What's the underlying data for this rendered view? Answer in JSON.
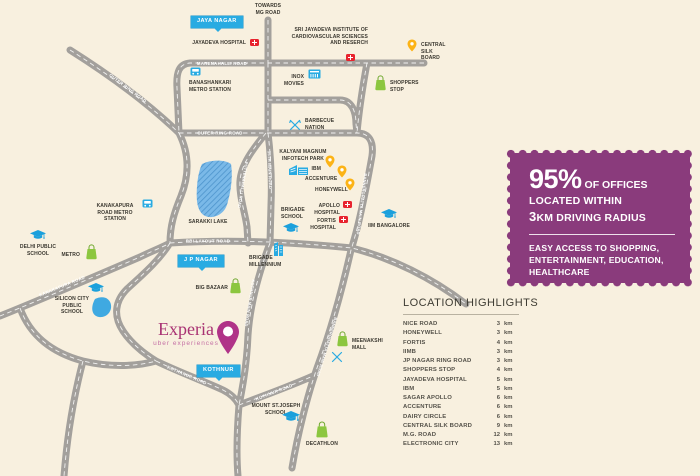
{
  "brand": {
    "name": "Experia",
    "tagline": "uber experiences"
  },
  "infobox": {
    "stat": "95%",
    "stat_suffix": "OF OFFICES",
    "line2": "LOCATED WITHIN",
    "line3_num": "3",
    "line3_rest": "KM DRIVING RADIUS",
    "secondary": "EASY ACCESS TO SHOPPING, ENTERTAINMENT, EDUCATION, HEALTHCARE"
  },
  "highlights": {
    "title": "LOCATION HIGHLIGHTS",
    "items": [
      {
        "name": "NICE ROAD",
        "distance": "3",
        "unit": "km"
      },
      {
        "name": "HONEYWELL",
        "distance": "3",
        "unit": "km"
      },
      {
        "name": "FORTIS",
        "distance": "4",
        "unit": "km"
      },
      {
        "name": "IIMB",
        "distance": "3",
        "unit": "km"
      },
      {
        "name": "JP NAGAR RING ROAD",
        "distance": "3",
        "unit": "km"
      },
      {
        "name": "SHOPPERS STOP",
        "distance": "4",
        "unit": "km"
      },
      {
        "name": "JAYADEVA HOSPITAL",
        "distance": "5",
        "unit": "km"
      },
      {
        "name": "IBM",
        "distance": "5",
        "unit": "km"
      },
      {
        "name": "SAGAR APOLLO",
        "distance": "6",
        "unit": "km"
      },
      {
        "name": "ACCENTURE",
        "distance": "6",
        "unit": "km"
      },
      {
        "name": "DAIRY CIRCLE",
        "distance": "6",
        "unit": "km"
      },
      {
        "name": "CENTRAL SILK BOARD",
        "distance": "9",
        "unit": "km"
      },
      {
        "name": "M.G. ROAD",
        "distance": "12",
        "unit": "km"
      },
      {
        "name": "ELECTRONIC CITY",
        "distance": "13",
        "unit": "km"
      }
    ]
  },
  "map": {
    "direction_label": "TOWARDS MG ROAD",
    "badges": {
      "jaya_nagar": "JAYA NAGAR",
      "jp_nagar": "J P NAGAR",
      "kothnur": "KOTHNUR"
    },
    "roads": {
      "marenahalli": "MARENAHALLI ROAD",
      "outer_ring_1": "OUTER RING ROAD",
      "outer_ring_2": "OUTER RING ROAD",
      "main_15th": "15TH MAIN ROAD",
      "puttenahalli": "PUTTENAHALLI ROAD",
      "rbi_layout": "RBI LAYOUT ROAD",
      "kanakapura": "KANAKAPURA ROAD",
      "bannerghatta_1": "BANNERGHATTA MAIN ROAD",
      "bannerghatta_2": "BANNERGHATTA MAIN ROAD",
      "kothnur_main": "KOTHNUR MAIN ROAD",
      "kothnur_1": "KOTHNUR ROAD",
      "kothanur_2": "KOTHANUR ROAD"
    },
    "landmarks": {
      "jayadeva_hospital": "JAYADEVA HOSPITAL",
      "sri_jayadeva": "SRI JAYADEVA INSTITUTE OF CARDIOVASCULAR SCIENCES AND RESERCH",
      "central_silk_board": "CENTRAL SILK BOARD",
      "banashankari_metro": "BANASHANKARI METRO STATION",
      "inox_movies": "INOX MOVIES",
      "shoppers_stop": "SHOPPERS STOP",
      "barbecue_nation": "BARBECUE NATION",
      "kalyani_magnum": "KALYANI MAGNUM INFOTECH PARK",
      "ibm": "IBM",
      "accenture": "ACCENTURE",
      "honeywell": "HONEYWELL",
      "apollo_hospital": "APOLLO HOSPITAL",
      "fortis_hospital": "FORTIS HOSPITAL",
      "brigade_school": "BRIGADE SCHOOL",
      "sarakki_lake": "SARAKKI LAKE",
      "kanakapura_metro": "KANAKAPURA ROAD METRO STATION",
      "iim_bangalore": "IIM BANGALORE",
      "delhi_public_school": "DELHI PUBLIC SCHOOL",
      "metro_store": "METRO",
      "silicon_city_school": "SILICON CITY PUBLIC SCHOOL",
      "brigade_millennium": "BRIGADE MILLENNIUM",
      "big_bazaar": "BIG BAZAAR",
      "meenakshi_mall": "MEENAKSHI MALL",
      "mount_st_joseph": "MOUNT ST.JOSEPH SCHOOL",
      "decathlon": "DECATHLON"
    },
    "colors": {
      "accent_purple": "#8a3b7c",
      "magenta": "#a93273",
      "cyan": "#29abe2",
      "yellow": "#fcb316",
      "green": "#8cc63f",
      "red": "#e8232e",
      "road": "#a3a09c",
      "background": "#f8f0df"
    }
  }
}
